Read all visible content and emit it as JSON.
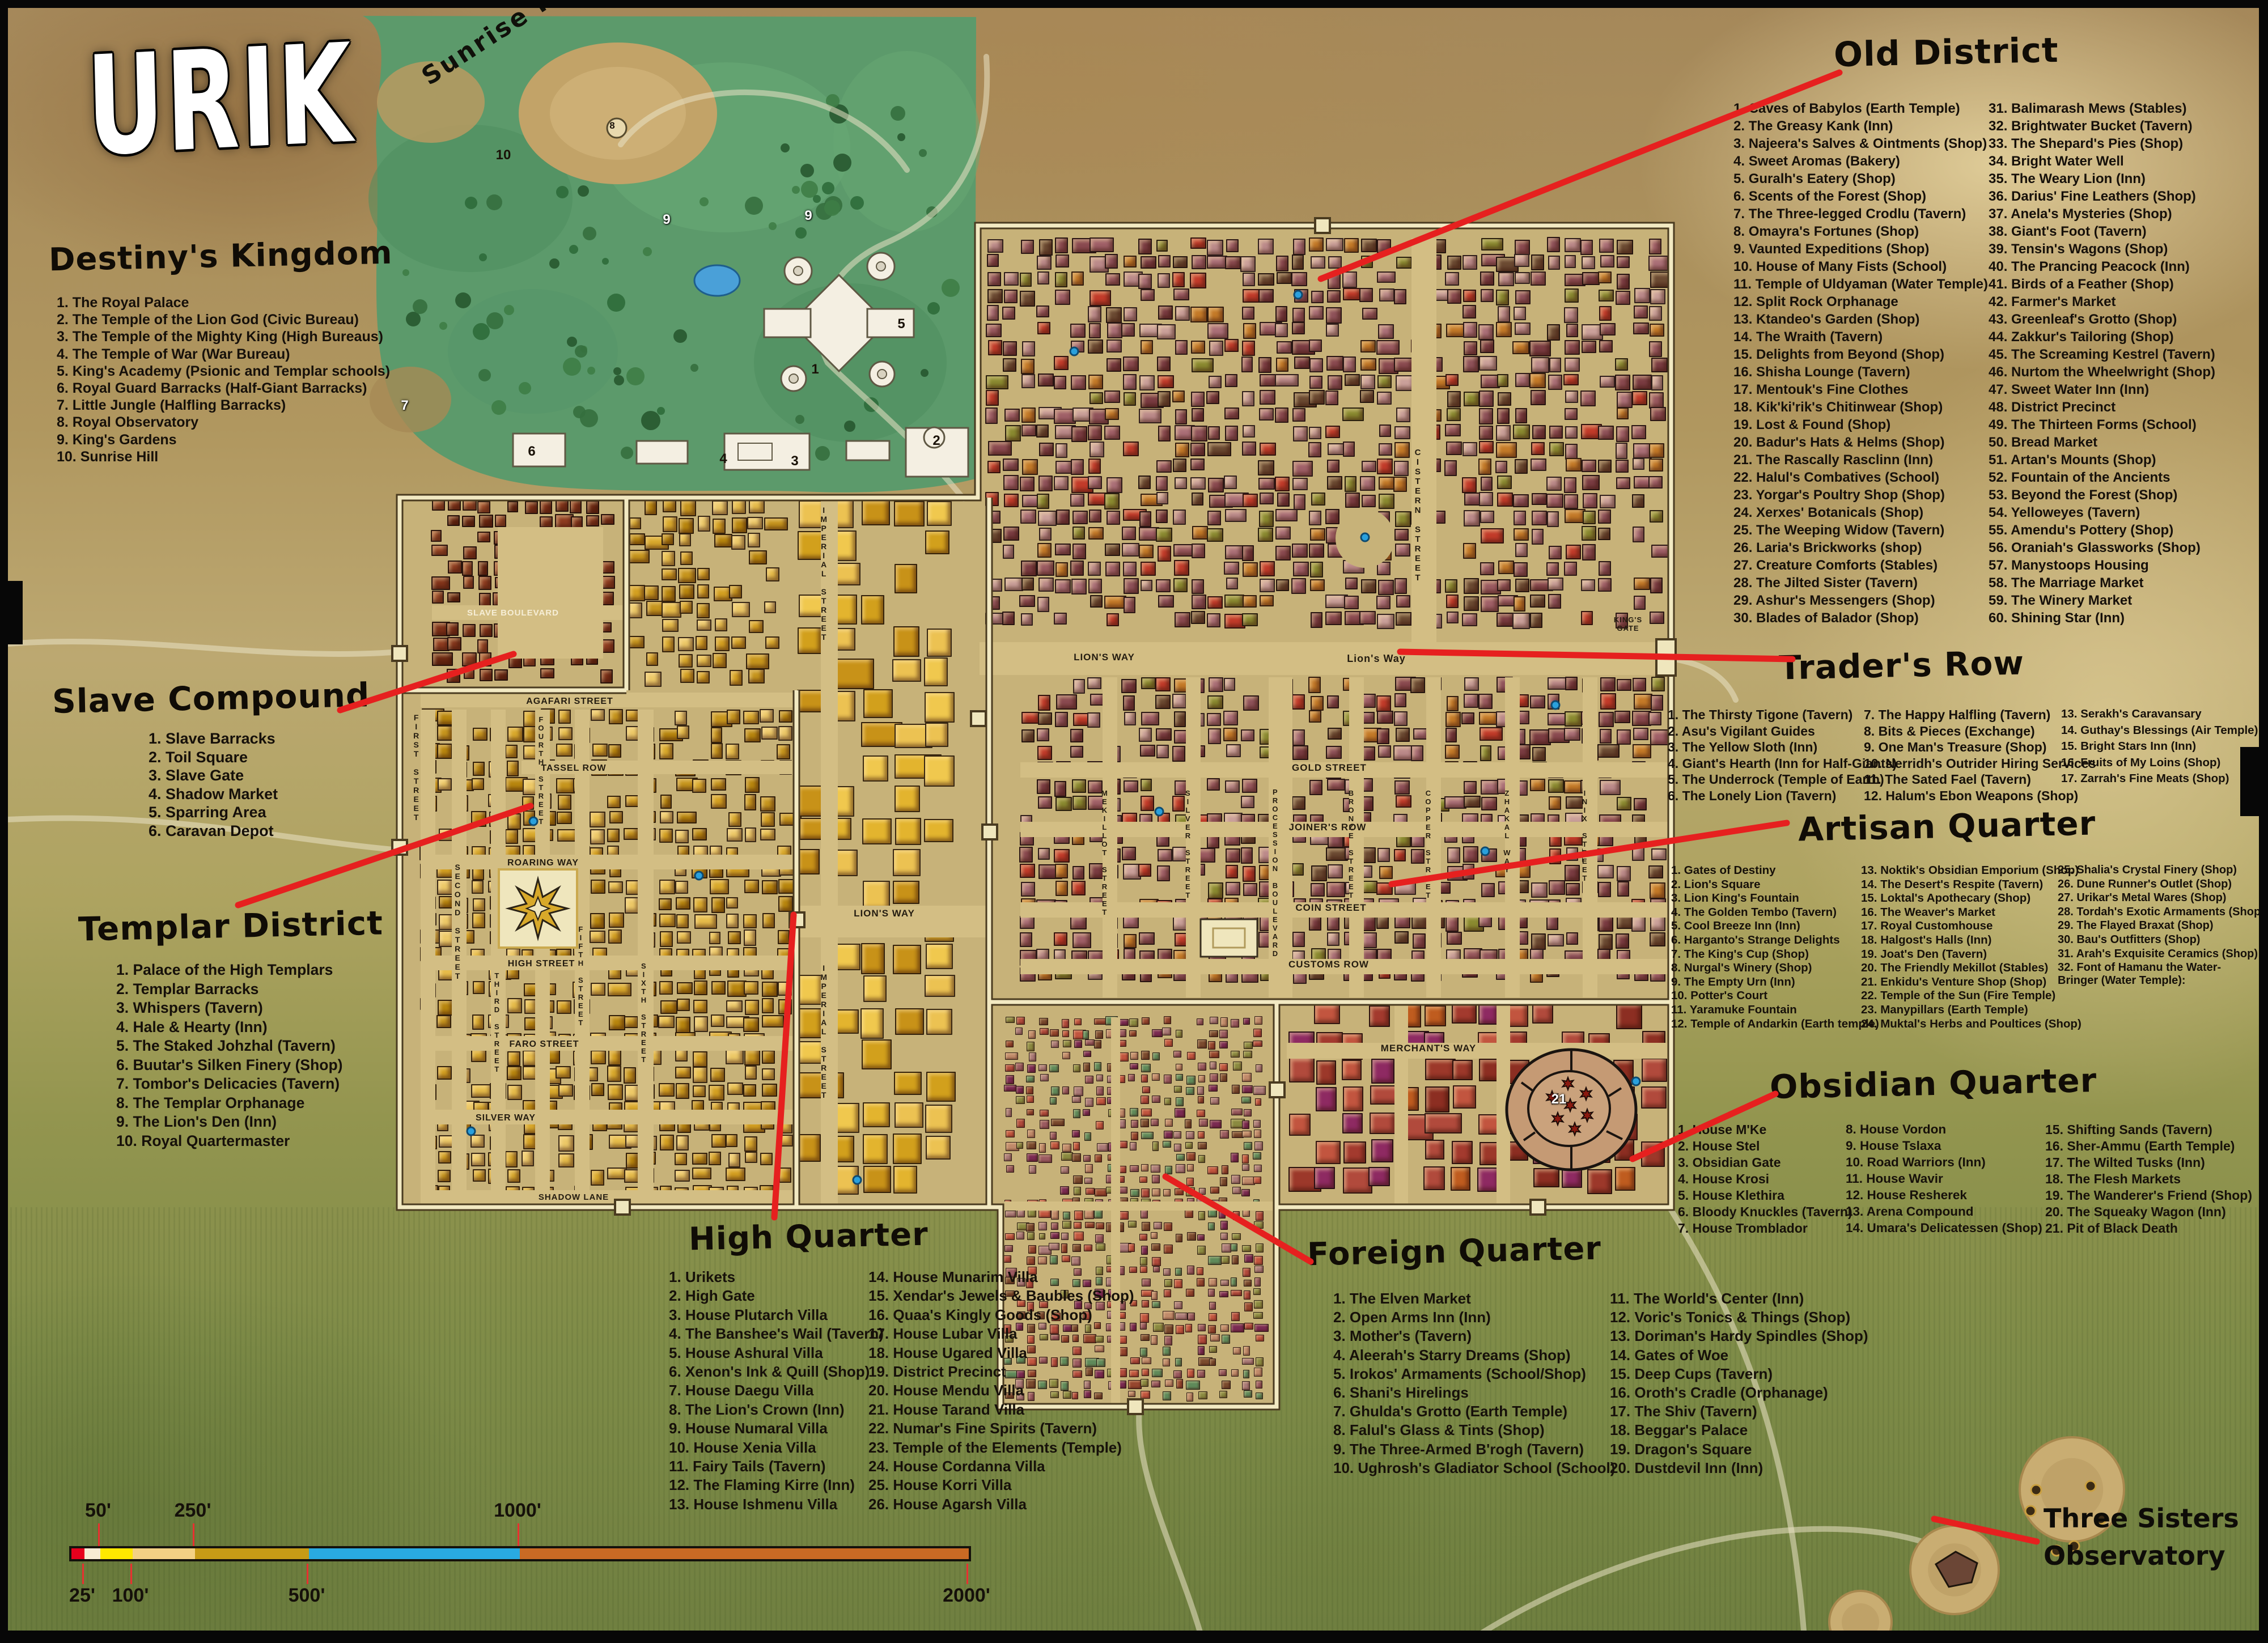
{
  "title": "URIK",
  "labels": {
    "sunrise_hill": "Sunrise Hill",
    "three_sisters_1": "Three Sisters",
    "three_sisters_2": "Observatory"
  },
  "streets": {
    "slave_blvd": "SLAVE BOULEVARD",
    "agafari": "AGAFARI STREET",
    "tassel": "TASSEL ROW",
    "roaring": "ROARING WAY",
    "high_st": "HIGH STREET",
    "faro": "FARO STREET",
    "silver_way": "SILVER WAY",
    "shadow": "SHADOW LANE",
    "first": "FIRST STREET",
    "second": "SECOND STREET",
    "third": "THIRD STREET",
    "fourth": "FOURTH STREET",
    "fifth": "FIFTH STREET",
    "sixth": "SIXTH STREET",
    "lions_way_w": "LION'S WAY",
    "lions_way_c": "Lion's Way",
    "lions_way_h": "LION'S WAY",
    "imperial_1": "IMPERIAL STREET",
    "imperial_2": "IMPERIAL STREET",
    "kings_gate": "KING'S GATE",
    "cistern": "CISTERN STREET",
    "gold": "GOLD STREET",
    "joiners": "JOINER'S ROW",
    "coin": "COIN STREET",
    "customs": "CUSTOMS ROW",
    "mekillot": "MEKILLOT STREET",
    "silver_st": "SILVER STREET",
    "procession": "PROCESSION BOULEVARD",
    "bronze": "BRONZE STREET",
    "copper": "COPPER STREET",
    "zhakal": "ZHAKAL WAY",
    "inix": "INIX STREET",
    "merchants": "MERCHANT'S WAY"
  },
  "map_markers": [
    "1",
    "2",
    "3",
    "4",
    "5",
    "6",
    "7",
    "8",
    "9",
    "9",
    "10",
    "21"
  ],
  "districts": [
    {
      "id": "destiny",
      "name": "Destiny's Kingdom",
      "columns": [
        [
          "The Royal Palace",
          "The Temple of the Lion God (Civic Bureau)",
          "The Temple of the Mighty King (High Bureaus)",
          "The Temple of War (War Bureau)",
          "King's Academy (Psionic and Templar schools)",
          "Royal Guard Barracks (Half-Giant Barracks)",
          "Little Jungle (Halfling Barracks)",
          "Royal Observatory",
          "King's Gardens",
          "Sunrise Hill"
        ]
      ]
    },
    {
      "id": "old",
      "name": "Old District",
      "columns": [
        [
          "Caves of Babylos (Earth Temple)",
          "The Greasy Kank (Inn)",
          "Najeera's Salves & Ointments (Shop)",
          "Sweet Aromas (Bakery)",
          "Guralh's Eatery (Shop)",
          "Scents of the Forest (Shop)",
          "The Three-legged Crodlu (Tavern)",
          "Omayra's Fortunes (Shop)",
          "Vaunted Expeditions (Shop)",
          "House of Many Fists (School)",
          "Temple of Uldyaman (Water Temple)",
          "Split Rock Orphanage",
          "Ktandeo's Garden (Shop)",
          "The Wraith (Tavern)",
          "Delights from Beyond (Shop)",
          "Shisha Lounge (Tavern)",
          "Mentouk's Fine Clothes",
          "Kik'ki'rik's Chitinwear (Shop)",
          "Lost & Found (Shop)",
          "Badur's Hats & Helms (Shop)",
          "The Rascally Rasclinn (Inn)",
          "Halul's Combatives (School)",
          "Yorgar's Poultry Shop (Shop)",
          "Xerxes' Botanicals (Shop)",
          "The Weeping Widow (Tavern)",
          "Laria's Brickworks (shop)",
          "Creature Comforts (Stables)",
          "The Jilted Sister (Tavern)",
          "Ashur's Messengers (Shop)",
          "Blades of Balador (Shop)"
        ],
        [
          "Balimarash Mews (Stables)",
          "Brightwater Bucket (Tavern)",
          "The Shepard's Pies (Shop)",
          "Bright Water Well",
          "The Weary Lion (Inn)",
          "Darius' Fine Leathers (Shop)",
          "Anela's Mysteries (Shop)",
          "Giant's Foot (Tavern)",
          "Tensin's Wagons (Shop)",
          "The Prancing Peacock (Inn)",
          "Birds of a Feather (Shop)",
          "Farmer's Market",
          "Greenleaf's Grotto (Shop)",
          "Zakkur's Tailoring (Shop)",
          "The Screaming Kestrel (Tavern)",
          "Nurtom the Wheelwright (Shop)",
          "Sweet Water Inn (Inn)",
          "District Precinct",
          "The Thirteen Forms (School)",
          "Bread Market",
          "Artan's Mounts (Shop)",
          "Fountain of the Ancients",
          "Beyond the Forest (Shop)",
          "Yelloweyes (Tavern)",
          "Amendu's Pottery (Shop)",
          "Oraniah's Glassworks (Shop)",
          "Manystoops Housing",
          "The Marriage Market",
          "The Winery Market",
          "Shining Star (Inn)"
        ]
      ]
    },
    {
      "id": "slave",
      "name": "Slave Compound",
      "columns": [
        [
          "Slave Barracks",
          "Toil Square",
          "Slave Gate",
          "Shadow Market",
          "Sparring Area",
          "Caravan Depot"
        ]
      ]
    },
    {
      "id": "traders",
      "name": "Trader's Row",
      "columns": [
        [
          "The Thirsty Tigone (Tavern)",
          "Asu's Vigilant Guides",
          "The Yellow Sloth (Inn)",
          "Giant's Hearth (Inn for Half-Giants)",
          "The Underrock (Temple of Earth)",
          "The Lonely Lion (Tavern)"
        ],
        [
          "The Happy Halfling (Tavern)",
          "Bits & Pieces (Exchange)",
          "One Man's Treasure (Shop)",
          "Nerridh's Outrider Hiring Services",
          "The Sated Fael (Tavern)",
          "Halum's Ebon Weapons (Shop)"
        ],
        [
          "Serakh's Caravansary",
          "Guthay's Blessings (Air Temple)",
          "Bright Stars Inn (Inn)",
          "Fruits of My Loins (Shop)",
          "Zarrah's Fine Meats (Shop)"
        ]
      ]
    },
    {
      "id": "templar",
      "name": "Templar District",
      "columns": [
        [
          "Palace of the High Templars",
          "Templar Barracks",
          "Whispers (Tavern)",
          "Hale & Hearty (Inn)",
          "The Staked Johzhal (Tavern)",
          "Buutar's Silken Finery (Shop)",
          "Tombor's Delicacies (Tavern)",
          "The Templar Orphanage",
          "The Lion's Den (Inn)",
          "Royal Quartermaster"
        ]
      ]
    },
    {
      "id": "artisan",
      "name": "Artisan Quarter",
      "columns": [
        [
          "Gates of Destiny",
          "Lion's Square",
          "Lion King's Fountain",
          "The Golden Tembo (Tavern)",
          "Cool Breeze Inn (Inn)",
          "Harganto's Strange Delights",
          "The King's Cup (Shop)",
          "Nurgal's Winery (Shop)",
          "The Empty Urn (Inn)",
          "Potter's Court",
          "Yaramuke Fountain",
          "Temple of Andarkin (Earth temple)"
        ],
        [
          "Noktik's Obsidian Emporium (Shop)",
          "The Desert's Respite (Tavern)",
          "Loktal's Apothecary (Shop)",
          "The Weaver's Market",
          "Royal Customhouse",
          "Halgost's Halls (Inn)",
          "Joat's Den (Tavern)",
          "The Friendly Mekillot (Stables)",
          "Enkidu's Venture Shop (Shop)",
          "Temple of the Sun (Fire Temple)",
          "Manypillars (Earth Temple)",
          "Muktal's Herbs and Poultices (Shop)"
        ],
        [
          "Shalia's Crystal Finery (Shop)",
          "Dune Runner's Outlet (Shop)",
          "Urikar's Metal Wares (Shop)",
          "Tordah's Exotic Armaments (Shop)",
          "The Flayed Braxat (Shop)",
          "Bau's Outfitters (Shop)",
          "Arah's Exquisite Ceramics (Shop)",
          "Font of Hamanu the Water-Bringer (Water Temple):"
        ]
      ]
    },
    {
      "id": "obsidian",
      "name": "Obsidian Quarter",
      "columns": [
        [
          "House M'Ke",
          "House Stel",
          "Obsidian Gate",
          "House Krosi",
          "House Klethira",
          "Bloody Knuckles (Tavern)",
          "House Tromblador"
        ],
        [
          "House Vordon",
          "House Tslaxa",
          "Road Warriors (Inn)",
          "House Wavir",
          "House Resherek",
          "Arena Compound",
          "Umara's Delicatessen (Shop)"
        ],
        [
          "Shifting Sands (Tavern)",
          "Sher-Ammu (Earth Temple)",
          "The Wilted Tusks (Inn)",
          "The Flesh Markets",
          "The Wanderer's Friend (Shop)",
          "The Squeaky Wagon (Inn)",
          "Pit of Black Death"
        ]
      ]
    },
    {
      "id": "high",
      "name": "High Quarter",
      "columns": [
        [
          "Urikets",
          "High Gate",
          "House Plutarch Villa",
          "The Banshee's Wail (Tavern)",
          "House Ashural Villa",
          "Xenon's Ink & Quill (Shop)",
          "House Daegu Villa",
          "The Lion's Crown (Inn)",
          "House Numaral Villa",
          "House Xenia Villa",
          "Fairy Tails (Tavern)",
          "The Flaming Kirre (Inn)",
          "House Ishmenu Villa"
        ],
        [
          "House Munarim Villa",
          "Xendar's Jewels & Baubles (Shop)",
          "Quaa's Kingly Goods (Shop)",
          "House Lubar Villa",
          "House Ugared Villa",
          "District Precinct",
          "House Mendu Villa",
          "House Tarand Villa",
          "Numar's Fine Spirits (Tavern)",
          "Temple of the Elements (Temple)",
          "House Cordanna Villa",
          "House Korri Villa",
          "House Agarsh Villa"
        ]
      ]
    },
    {
      "id": "foreign",
      "name": "Foreign Quarter",
      "columns": [
        [
          "The Elven Market",
          "Open Arms Inn (Inn)",
          "Mother's (Tavern)",
          "Aleerah's Starry Dreams (Shop)",
          "Irokos' Armaments (School/Shop)",
          "Shani's Hirelings",
          "Ghulda's Grotto (Earth Temple)",
          "Falul's Glass & Tints (Shop)",
          "The Three-Armed B'rogh (Tavern)",
          "Ughrosh's Gladiator School (School)"
        ],
        [
          "The World's Center (Inn)",
          "Voric's Tonics & Things (Shop)",
          "Doriman's Hardy Spindles (Shop)",
          "Gates of Woe",
          "Deep Cups (Tavern)",
          "Oroth's Cradle (Orphanage)",
          "The Shiv (Tavern)",
          "Beggar's Palace",
          "Dragon's Square",
          "Dustdevil Inn (Inn)"
        ]
      ]
    }
  ],
  "scale_bar": {
    "top_labels": [
      "50'",
      "250'",
      "1000'"
    ],
    "bottom_labels": [
      "25'",
      "100'",
      "500'",
      "2000'"
    ],
    "segments": [
      {
        "label": "25'",
        "color": "#e8001d"
      },
      {
        "label": "50'",
        "color": "#f7ecd4"
      },
      {
        "label": "100'",
        "color": "#ffe800"
      },
      {
        "label": "250'",
        "color": "#f3d184"
      },
      {
        "label": "500'",
        "color": "#c79b16"
      },
      {
        "label": "1000'",
        "color": "#29aae1"
      },
      {
        "label": "2000'",
        "color": "#c96a24"
      }
    ]
  },
  "colors": {
    "red_line": "#e6201f"
  }
}
